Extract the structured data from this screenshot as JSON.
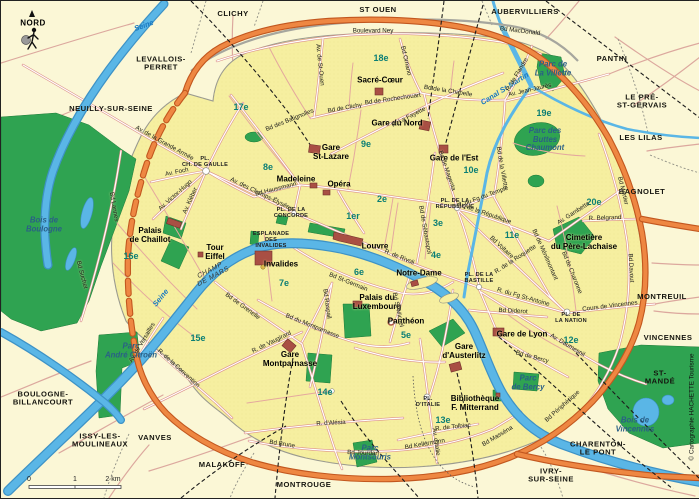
{
  "map": {
    "compass": {
      "label": "NORD"
    },
    "scale": {
      "tick0": "0",
      "tick1": "1",
      "tick2": "2 km"
    },
    "copyright": "© Cartographie HACHETTE Tourisme",
    "colors": {
      "outside_background": "#FBF7D6",
      "paris_fill": "#F6EFA0",
      "park_green": "#2FA351",
      "water_blue": "#5AB6E6",
      "ring_road_orange": "#EE8742",
      "road_casing_red": "#DC9088",
      "landmark_red": "#A94F44",
      "district_teal": "#0B7E74",
      "park_label_blue": "#2A5F86",
      "water_label_blue": "#1878C0"
    },
    "labels": [
      {
        "t": "CLICHY",
        "x": 232,
        "y": 13,
        "c": "city"
      },
      {
        "t": "ST OUEN",
        "x": 377,
        "y": 9,
        "c": "city"
      },
      {
        "t": "AUBERVILLIERS",
        "x": 524,
        "y": 11,
        "c": "city"
      },
      {
        "t": "PANTIN",
        "x": 611,
        "y": 58,
        "c": "city"
      },
      {
        "t": "LEVALLOIS-\nPERRET",
        "x": 160,
        "y": 63,
        "c": "city"
      },
      {
        "t": "NEUILLY-SUR-SEINE",
        "x": 110,
        "y": 108,
        "c": "city"
      },
      {
        "t": "LE PRÉ-\nST-GERVAIS",
        "x": 641,
        "y": 101,
        "c": "city"
      },
      {
        "t": "LES LILAS",
        "x": 640,
        "y": 137,
        "c": "city"
      },
      {
        "t": "BAGNOLET",
        "x": 641,
        "y": 191,
        "c": "city"
      },
      {
        "t": "MONTREUIL",
        "x": 661,
        "y": 296,
        "c": "city"
      },
      {
        "t": "VINCENNES",
        "x": 667,
        "y": 337,
        "c": "city"
      },
      {
        "t": "ST-MANDÉ",
        "x": 659,
        "y": 377,
        "c": "city"
      },
      {
        "t": "CHARENTON-\nLE PONT",
        "x": 597,
        "y": 448,
        "c": "city"
      },
      {
        "t": "IVRY-\nSUR-SEINE",
        "x": 550,
        "y": 475,
        "c": "city"
      },
      {
        "t": "MONTROUGE",
        "x": 303,
        "y": 484,
        "c": "city"
      },
      {
        "t": "MALAKOFF",
        "x": 221,
        "y": 464,
        "c": "city"
      },
      {
        "t": "VANVES",
        "x": 154,
        "y": 437,
        "c": "city"
      },
      {
        "t": "ISSY-LES-\nMOULINEAUX",
        "x": 99,
        "y": 440,
        "c": "city"
      },
      {
        "t": "BOULOGNE-\nBILLANCOURT",
        "x": 42,
        "y": 398,
        "c": "city"
      },
      {
        "t": "1er",
        "x": 352,
        "y": 216,
        "c": "district"
      },
      {
        "t": "2e",
        "x": 381,
        "y": 199,
        "c": "district"
      },
      {
        "t": "3e",
        "x": 437,
        "y": 223,
        "c": "district"
      },
      {
        "t": "4e",
        "x": 435,
        "y": 255,
        "c": "district"
      },
      {
        "t": "5e",
        "x": 405,
        "y": 335,
        "c": "district"
      },
      {
        "t": "6e",
        "x": 358,
        "y": 272,
        "c": "district"
      },
      {
        "t": "7e",
        "x": 283,
        "y": 283,
        "c": "district"
      },
      {
        "t": "8e",
        "x": 267,
        "y": 167,
        "c": "district"
      },
      {
        "t": "9e",
        "x": 365,
        "y": 144,
        "c": "district"
      },
      {
        "t": "10e",
        "x": 470,
        "y": 170,
        "c": "district"
      },
      {
        "t": "11e",
        "x": 511,
        "y": 235,
        "c": "district"
      },
      {
        "t": "12e",
        "x": 570,
        "y": 340,
        "c": "district"
      },
      {
        "t": "13e",
        "x": 442,
        "y": 420,
        "c": "district"
      },
      {
        "t": "14e",
        "x": 324,
        "y": 392,
        "c": "district"
      },
      {
        "t": "15e",
        "x": 197,
        "y": 338,
        "c": "district"
      },
      {
        "t": "16e",
        "x": 130,
        "y": 256,
        "c": "district"
      },
      {
        "t": "17e",
        "x": 240,
        "y": 107,
        "c": "district"
      },
      {
        "t": "18e",
        "x": 380,
        "y": 58,
        "c": "district"
      },
      {
        "t": "19e",
        "x": 543,
        "y": 113,
        "c": "district"
      },
      {
        "t": "20e",
        "x": 593,
        "y": 202,
        "c": "district"
      },
      {
        "t": "Sacré-Cœur",
        "x": 379,
        "y": 80,
        "c": "landmark"
      },
      {
        "t": "Gare\nSt-Lazare",
        "x": 330,
        "y": 152,
        "c": "landmark"
      },
      {
        "t": "Gare du Nord",
        "x": 396,
        "y": 123,
        "c": "landmark"
      },
      {
        "t": "Gare de l'Est",
        "x": 453,
        "y": 158,
        "c": "landmark"
      },
      {
        "t": "Madeleine",
        "x": 295,
        "y": 179,
        "c": "landmark"
      },
      {
        "t": "Opéra",
        "x": 338,
        "y": 184,
        "c": "landmark"
      },
      {
        "t": "Louvre",
        "x": 374,
        "y": 246,
        "c": "landmark"
      },
      {
        "t": "Notre-Dame",
        "x": 418,
        "y": 273,
        "c": "landmark"
      },
      {
        "t": "Palais\nde Chaillot",
        "x": 149,
        "y": 235,
        "c": "landmark"
      },
      {
        "t": "Tour\nEiffel",
        "x": 214,
        "y": 252,
        "c": "landmark"
      },
      {
        "t": "Invalides",
        "x": 280,
        "y": 264,
        "c": "landmark"
      },
      {
        "t": "Palais du\nLuxembourg",
        "x": 376,
        "y": 302,
        "c": "landmark"
      },
      {
        "t": "Panthéon",
        "x": 405,
        "y": 321,
        "c": "landmark"
      },
      {
        "t": "Gare\nMontparnasse",
        "x": 289,
        "y": 359,
        "c": "landmark"
      },
      {
        "t": "Gare de Lyon",
        "x": 521,
        "y": 334,
        "c": "landmark"
      },
      {
        "t": "Gare\nd'Austerlitz",
        "x": 463,
        "y": 351,
        "c": "landmark"
      },
      {
        "t": "Bibliothèque\nF. Mitterrand",
        "x": 474,
        "y": 403,
        "c": "landmark"
      },
      {
        "t": "Cimetière\ndu Père-Lachaise",
        "x": 583,
        "y": 242,
        "c": "landmark"
      },
      {
        "t": "Bois de\nBoulogne",
        "x": 43,
        "y": 224,
        "c": "park"
      },
      {
        "t": "Bois de\nVincennes",
        "x": 634,
        "y": 424,
        "c": "park"
      },
      {
        "t": "Parc de\nLa Villette",
        "x": 552,
        "y": 68,
        "c": "park"
      },
      {
        "t": "Parc des\nButtes\nChaumont",
        "x": 544,
        "y": 139,
        "c": "park"
      },
      {
        "t": "Parc\nAndré Citroën",
        "x": 130,
        "y": 350,
        "c": "park"
      },
      {
        "t": "Parc\nMontsouris",
        "x": 369,
        "y": 452,
        "c": "park"
      },
      {
        "t": "Parc\nde Bercy",
        "x": 527,
        "y": 382,
        "c": "park"
      },
      {
        "t": "CHAMP\nDE MARS",
        "x": 211,
        "y": 273,
        "c": "champ",
        "r": -28
      },
      {
        "t": "PL.\nCH. DE GAULLE",
        "x": 204,
        "y": 161,
        "c": "place"
      },
      {
        "t": "PL. DE LA\nCONCORDE",
        "x": 290,
        "y": 212,
        "c": "place"
      },
      {
        "t": "ESPLANADE\nDES\nINVALIDES",
        "x": 270,
        "y": 239,
        "c": "place"
      },
      {
        "t": "PL. DE LA\nRÉPUBLIQUE",
        "x": 454,
        "y": 203,
        "c": "place"
      },
      {
        "t": "PL. DE LA\nBASTILLE",
        "x": 478,
        "y": 277,
        "c": "place"
      },
      {
        "t": "PL. DE\nLA NATION",
        "x": 570,
        "y": 317,
        "c": "place"
      },
      {
        "t": "PL.\nD'ITALIE",
        "x": 427,
        "y": 401,
        "c": "place"
      },
      {
        "t": "Seine",
        "x": 143,
        "y": 25,
        "c": "water",
        "r": -20
      },
      {
        "t": "Seine",
        "x": 160,
        "y": 297,
        "c": "water",
        "r": -51
      },
      {
        "t": "Canal St-Martin",
        "x": 504,
        "y": 88,
        "c": "water",
        "r": -32
      },
      {
        "t": "Boulevard Ney",
        "x": 372,
        "y": 31,
        "c": "street"
      },
      {
        "t": "Bd Ornano",
        "x": 404,
        "y": 60,
        "c": "street",
        "r": 77
      },
      {
        "t": "Av. de St-Ouen",
        "x": 318,
        "y": 64,
        "c": "street",
        "r": 84
      },
      {
        "t": "Bd des Batignolles",
        "x": 289,
        "y": 120,
        "c": "street",
        "r": -22
      },
      {
        "t": "Bd de Clichy",
        "x": 344,
        "y": 108,
        "c": "street",
        "r": -10
      },
      {
        "t": "Bd de Rochechouart",
        "x": 392,
        "y": 99,
        "c": "street",
        "r": -8
      },
      {
        "t": "Bd de la Chapelle",
        "x": 447,
        "y": 91,
        "c": "street",
        "r": 9
      },
      {
        "t": "Bd MacDonald",
        "x": 519,
        "y": 31,
        "c": "street",
        "r": 7
      },
      {
        "t": "R. La Fayette",
        "x": 408,
        "y": 117,
        "c": "street",
        "r": -27
      },
      {
        "t": "Bd de Magenta",
        "x": 445,
        "y": 170,
        "c": "street",
        "r": 71
      },
      {
        "t": "Bd de la Villette",
        "x": 500,
        "y": 167,
        "c": "street",
        "r": 80
      },
      {
        "t": "Av. Jean-Jaurès",
        "x": 529,
        "y": 90,
        "c": "street",
        "r": -13
      },
      {
        "t": "R. de Flandre",
        "x": 517,
        "y": 74,
        "c": "street",
        "r": -59
      },
      {
        "t": "Av. de la Grande Armée",
        "x": 163,
        "y": 143,
        "c": "street",
        "r": 29
      },
      {
        "t": "Av. Foch",
        "x": 176,
        "y": 172,
        "c": "street",
        "r": -12
      },
      {
        "t": "Av. Victor-Hugo",
        "x": 175,
        "y": 195,
        "c": "street",
        "r": -42
      },
      {
        "t": "Av. Kléber",
        "x": 190,
        "y": 200,
        "c": "street",
        "r": -66
      },
      {
        "t": "Av. des Champs-Élysées",
        "x": 260,
        "y": 194,
        "c": "street",
        "r": 26
      },
      {
        "t": "Bd Haussmann",
        "x": 275,
        "y": 189,
        "c": "street",
        "r": -14
      },
      {
        "t": "R. de Rivoli",
        "x": 398,
        "y": 257,
        "c": "street",
        "r": 22
      },
      {
        "t": "Bd de Sébastopol",
        "x": 423,
        "y": 229,
        "c": "street",
        "r": 80
      },
      {
        "t": "Bd St-Germain",
        "x": 347,
        "y": 282,
        "c": "street",
        "r": 22
      },
      {
        "t": "Bd St-Michel",
        "x": 396,
        "y": 309,
        "c": "street",
        "r": 78
      },
      {
        "t": "Bd Raspail",
        "x": 325,
        "y": 303,
        "c": "street",
        "r": 82
      },
      {
        "t": "Bd du Montparnasse",
        "x": 311,
        "y": 326,
        "c": "street",
        "r": 22
      },
      {
        "t": "R. de Vaugirard",
        "x": 271,
        "y": 342,
        "c": "street",
        "r": -26
      },
      {
        "t": "R. de la Convention",
        "x": 177,
        "y": 368,
        "c": "street",
        "r": 42
      },
      {
        "t": "Bd de Grenelle",
        "x": 241,
        "y": 306,
        "c": "street",
        "r": 36
      },
      {
        "t": "Av. de Versailles",
        "x": 142,
        "y": 342,
        "c": "street",
        "r": -59
      },
      {
        "t": "Bd Lannes",
        "x": 112,
        "y": 206,
        "c": "street",
        "r": 80
      },
      {
        "t": "Bd Suchet",
        "x": 80,
        "y": 274,
        "c": "street",
        "r": 75
      },
      {
        "t": "R. d'Alésia",
        "x": 330,
        "y": 423,
        "c": "street",
        "r": -3
      },
      {
        "t": "Bd Brune",
        "x": 281,
        "y": 444,
        "c": "street",
        "r": 9
      },
      {
        "t": "Bd Jourdan",
        "x": 362,
        "y": 453,
        "c": "street",
        "r": 2
      },
      {
        "t": "Bd Kellermann",
        "x": 424,
        "y": 444,
        "c": "street",
        "r": -10
      },
      {
        "t": "Av. d'Italie",
        "x": 434,
        "y": 441,
        "c": "street",
        "r": 82
      },
      {
        "t": "R. de Tolbiac",
        "x": 452,
        "y": 427,
        "c": "street",
        "r": -6
      },
      {
        "t": "Bd Masséna",
        "x": 497,
        "y": 436,
        "c": "street",
        "r": -31
      },
      {
        "t": "Bd Périphérique",
        "x": 562,
        "y": 406,
        "c": "street",
        "r": -42
      },
      {
        "t": "Av. Daumesnil",
        "x": 566,
        "y": 345,
        "c": "street",
        "r": 31
      },
      {
        "t": "Bd de Bercy",
        "x": 531,
        "y": 357,
        "c": "street",
        "r": 15
      },
      {
        "t": "Bd Diderot",
        "x": 512,
        "y": 311,
        "c": "street",
        "r": 3
      },
      {
        "t": "R. du Fg St-Antoine",
        "x": 522,
        "y": 297,
        "c": "street",
        "r": 16
      },
      {
        "t": "R. de la Roquette",
        "x": 515,
        "y": 259,
        "c": "street",
        "r": -33
      },
      {
        "t": "Bd Voltaire",
        "x": 500,
        "y": 247,
        "c": "street",
        "r": 43
      },
      {
        "t": "Av. de la République",
        "x": 483,
        "y": 213,
        "c": "street",
        "r": 19
      },
      {
        "t": "R. du Fg du Temple",
        "x": 482,
        "y": 197,
        "c": "street",
        "r": -20
      },
      {
        "t": "Bd de Ménilmontant",
        "x": 543,
        "y": 254,
        "c": "street",
        "r": 66
      },
      {
        "t": "Bd de Charonne",
        "x": 570,
        "y": 272,
        "c": "street",
        "r": 68
      },
      {
        "t": "Av. Gambetta",
        "x": 573,
        "y": 213,
        "c": "street",
        "r": -33
      },
      {
        "t": "R. Belgrand",
        "x": 604,
        "y": 218,
        "c": "street",
        "r": -2
      },
      {
        "t": "Bd Mortier",
        "x": 621,
        "y": 190,
        "c": "street",
        "r": 76
      },
      {
        "t": "Bd Davout",
        "x": 629,
        "y": 267,
        "c": "street",
        "r": 87
      },
      {
        "t": "Cours de Vincennes",
        "x": 609,
        "y": 306,
        "c": "street",
        "r": -7
      }
    ]
  }
}
